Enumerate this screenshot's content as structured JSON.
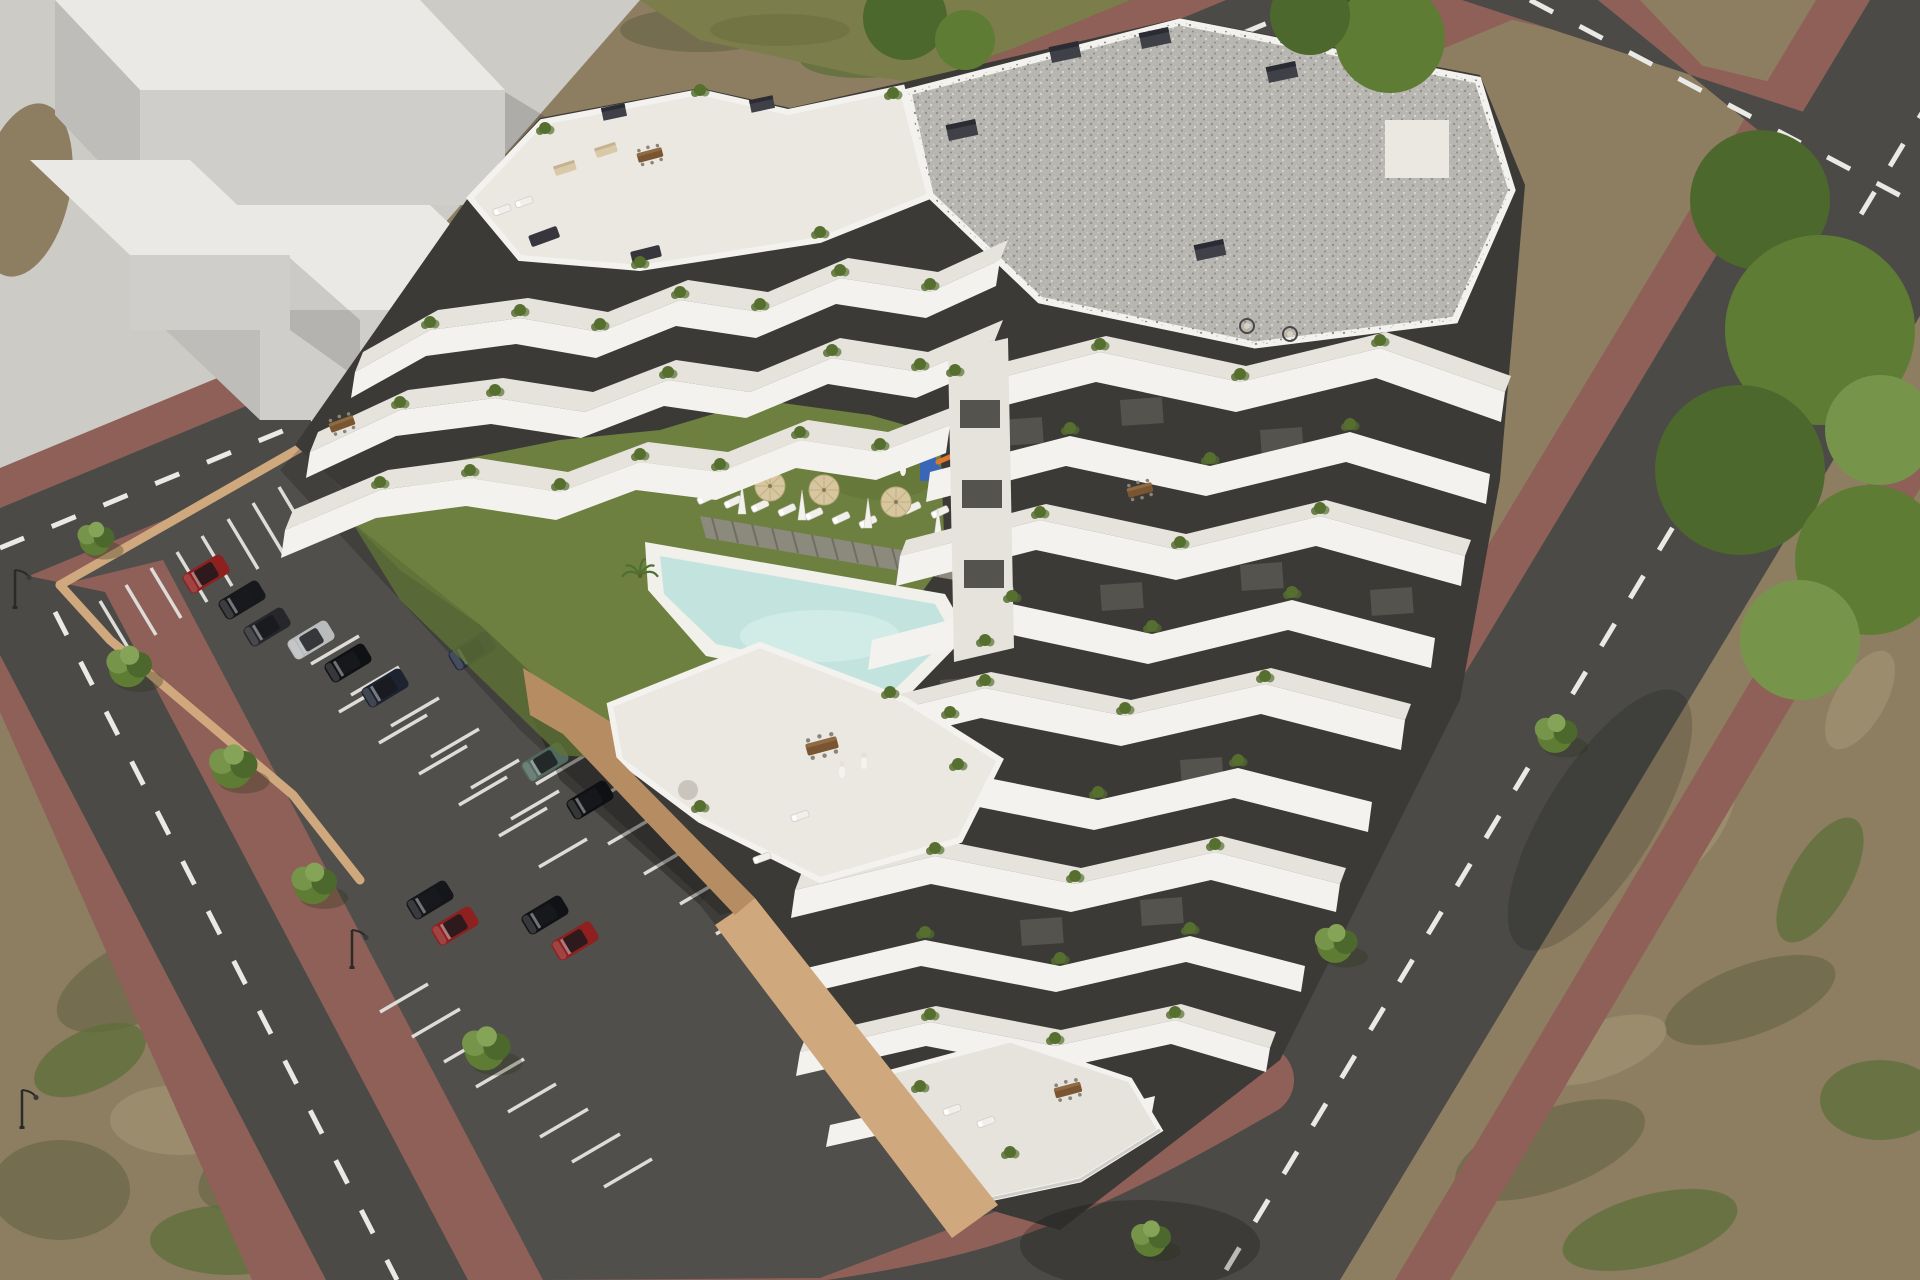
{
  "scene": {
    "description": "Aerial 3D architectural rendering of a modern white terraced apartment complex with curved balcony bands, a central courtyard with lawn, freeform swimming pool, sun loungers, parasols and a playground, an open-air parking lot with cars, surrounding roads with brick sidewalks, scrubland and an untextured massing-model building at the top left.",
    "time_of_day": "daylight, strong sun from upper left",
    "text_visible": "none"
  },
  "palette": {
    "dirt": "#8d7e62",
    "scrub_olive": "#6e694b",
    "scrub_green": "#5e6f3a",
    "scrub_light": "#a29273",
    "plaza": "#cdcbc6",
    "massing_top": "#eae9e5",
    "massing_front": "#d0cecb",
    "massing_side": "#bfbdb9",
    "grass_strip": "#7b7d4a",
    "asphalt": "#4b4a47",
    "parking_asphalt": "#514f4b",
    "brick_sidewalk": "#8f6058",
    "stall_stripe": "#dddcd8",
    "road_dash": "#e9e9e6",
    "wall_tan": "#cfa87e",
    "wall_tan_dark": "#b68d62",
    "building_white": "#f3f2ee",
    "building_deck": "#e6e3dd",
    "building_dark": "#3b3a37",
    "window_glass": "#55534d",
    "gravel_roof": "#b7b6b1",
    "terrace_tile": "#ebe8e2",
    "lawn": "#6d8040",
    "lawn_dark": "#5f7236",
    "pool_rim": "#f1f0ea",
    "pool_water": "#c3e4de",
    "pool_water_light": "#d5ece7",
    "pool_deck_wood": "#8b8a7c",
    "deck_slat": "#6f6e62",
    "umbrella": "#d8c79e",
    "parasol": "#f4f2ec",
    "playground_blue": "#3a66b8",
    "playground_orange": "#e0762f",
    "playground_red": "#c23b2e",
    "tree_mid": "#5f7c35",
    "tree_light": "#77954a",
    "tree_dark": "#4d682c",
    "plant_green": "#566f2f",
    "furniture_beige": "#d9c9a8",
    "furniture_brown": "#7a5532",
    "lamp_black": "#2a2a28",
    "people_white": "#f4f3ee"
  },
  "objects": {
    "massing_model": {
      "kind": "untextured white block massing study",
      "blocks": 3
    },
    "building": {
      "kind": "terraced apartment complex",
      "facade": "white curved balcony ribbons over dark charcoal walls",
      "roof": "flat gravel roof with chimney blocks",
      "greenery": "potted shrubs and planters on every terrace"
    },
    "courtyard": {
      "lawn": true,
      "pool": "freeform pool with white rim and pale aqua water",
      "pool_deck": "timber slat deck",
      "sun_loungers": 11,
      "parasols_open": 4,
      "parasols_closed": 4,
      "playground": "blue tower with slide, orange climber, seesaw"
    },
    "parking": {
      "stall_markings": "white painted stripes",
      "perimeter_wall": "tan retaining wall",
      "cars": [
        "#8e2020",
        "#17181b",
        "#26262b",
        "#b9bcbd",
        "#101114",
        "#1d2330",
        "#222b3d",
        "#52695f",
        "#0f1013",
        "#15161a",
        "#8e2020",
        "#111216",
        "#8e2020"
      ]
    },
    "streets": {
      "surface": "dark asphalt with white dashed center lines",
      "sidewalks": "reddish clay brick pavers",
      "street_lamps": 3,
      "street_trees": 8
    }
  }
}
